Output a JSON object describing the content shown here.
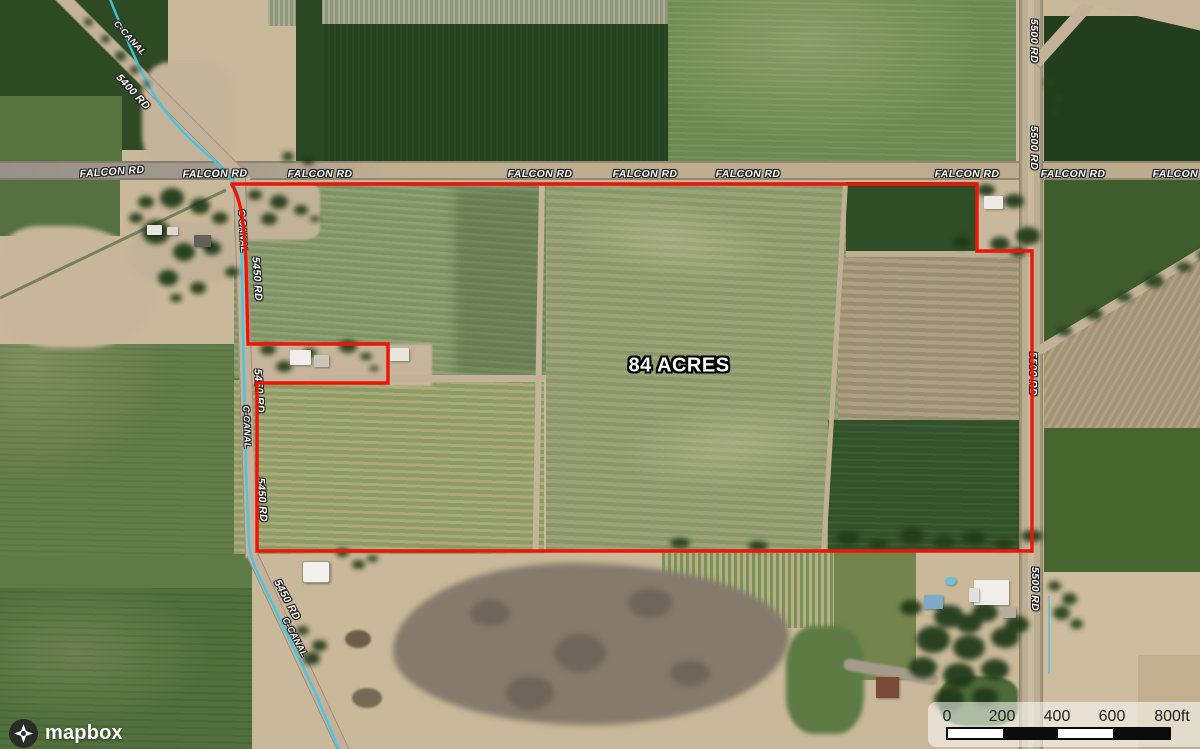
{
  "map": {
    "acreage_label": "84 ACRES",
    "roads": {
      "falcon_rd": "FALCON RD",
      "rd_5400": "5400 RD",
      "rd_5450": "5450 RD",
      "rd_5500": "5500 RD",
      "canal": "C-CANAL"
    }
  },
  "colors": {
    "boundary_red": "#ee1508",
    "canal_cyan": "#3fc6e8"
  },
  "scale_bar": {
    "ticks": [
      "0",
      "200",
      "400",
      "600",
      "800ft"
    ]
  },
  "attribution": {
    "logo_text": "mapbox"
  }
}
